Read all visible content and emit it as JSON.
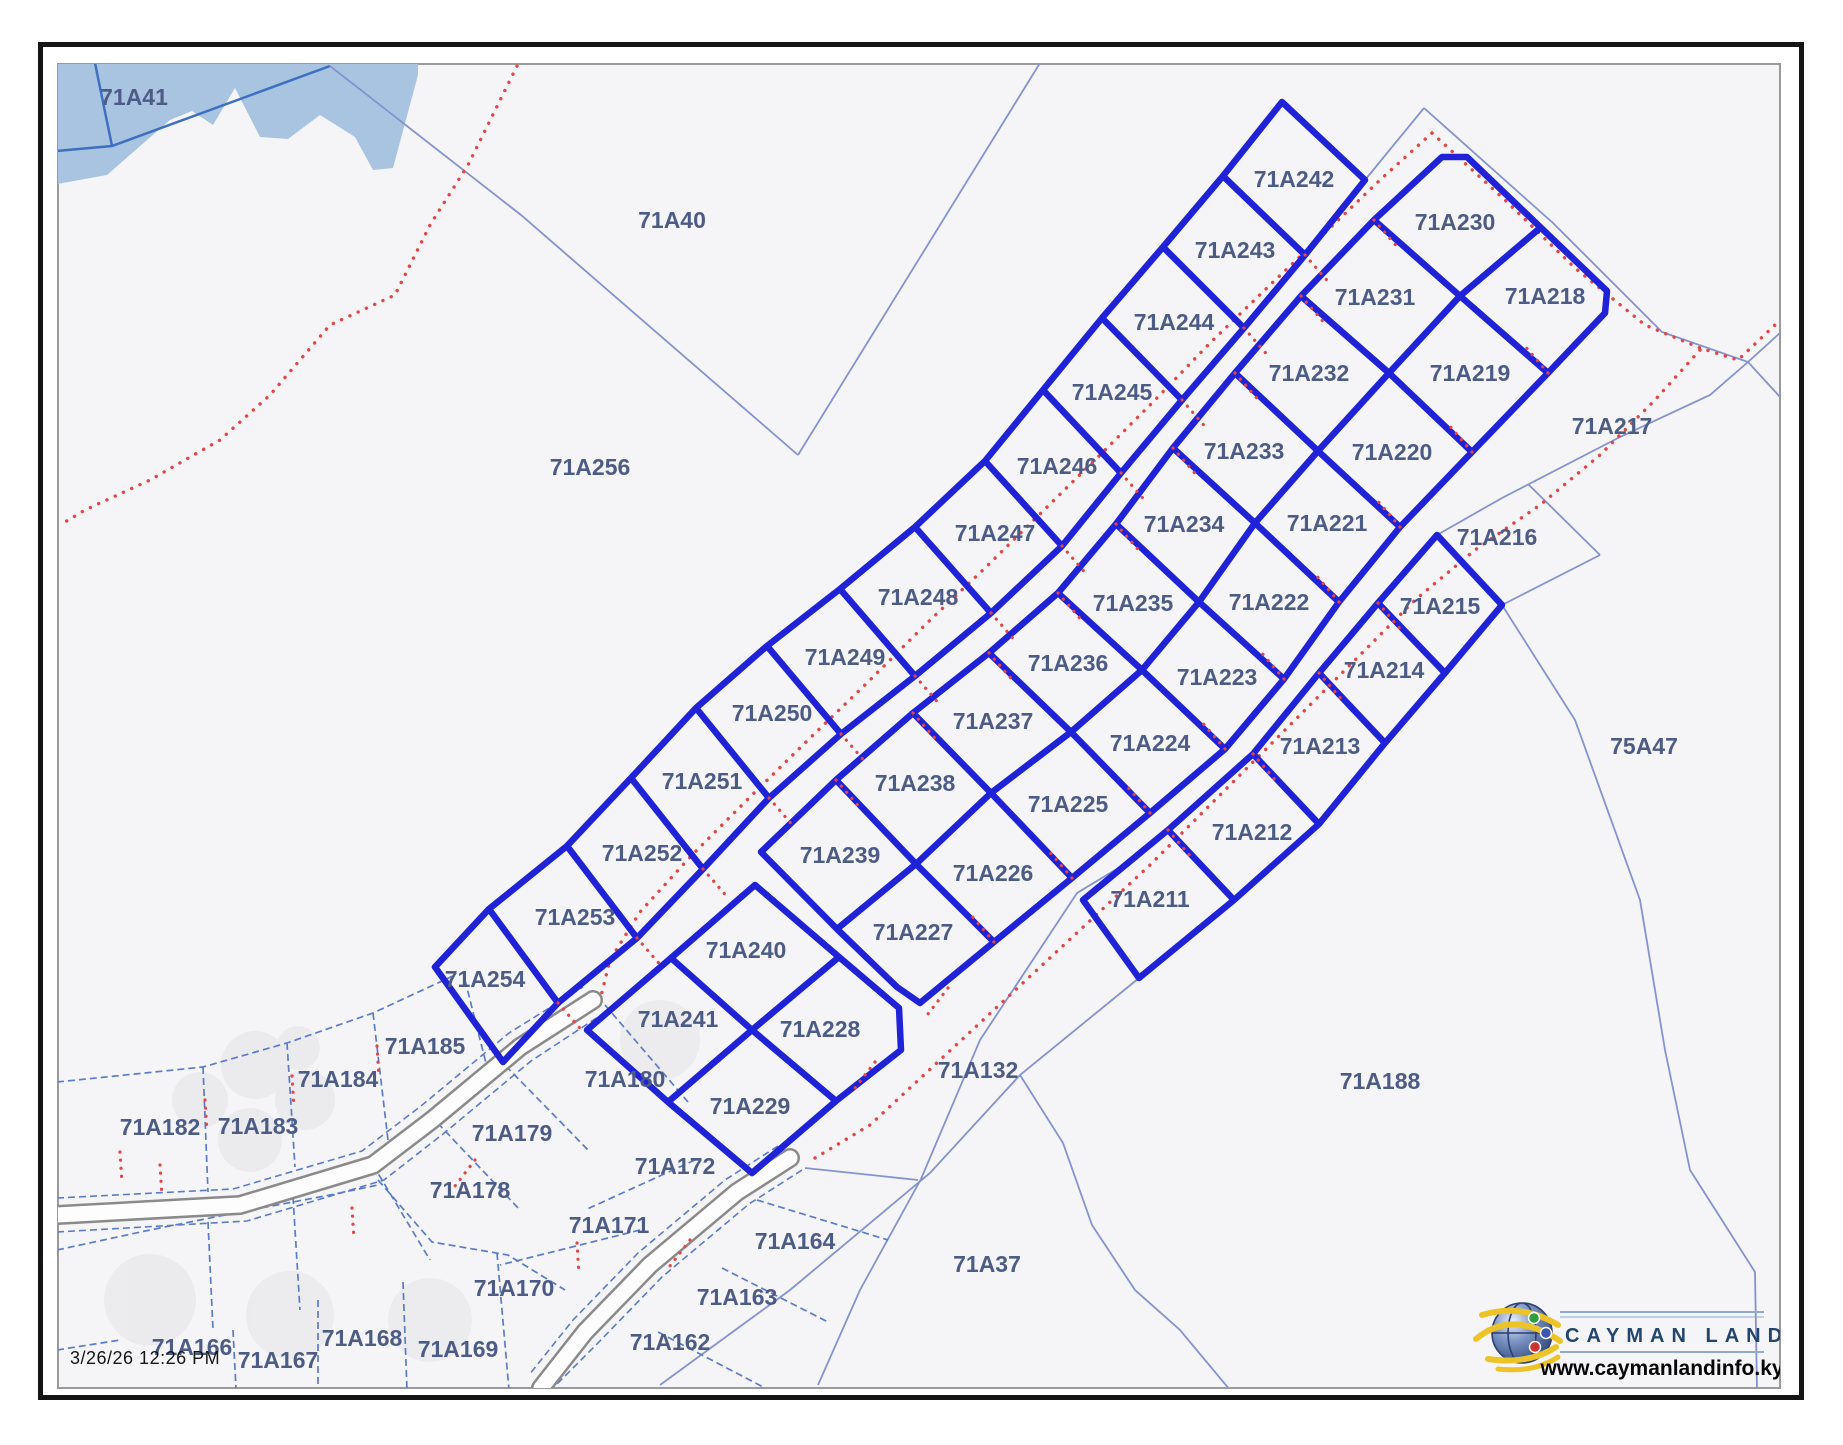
{
  "map": {
    "timestamp": "3/26/26 12:26 PM",
    "logo": {
      "brand": "CAYMAN LAND INFO",
      "url": "www.caymanlandinfo.ky"
    },
    "colors": {
      "highlight_boundary": "#1f22d6",
      "thin_boundary": "#8493cf",
      "village_boundary": "#5b7cc9",
      "road_casing": "#8a8a8a",
      "survey_marks": "#e34646",
      "water_fill": "#a9c4e1",
      "water_line": "#3f6fc1",
      "label_text": "#4d5c86"
    },
    "parcel_labels": [
      {
        "id": "71A41",
        "x": 134,
        "y": 97
      },
      {
        "id": "71A40",
        "x": 672,
        "y": 220
      },
      {
        "id": "71A256",
        "x": 590,
        "y": 467
      },
      {
        "id": "75A47",
        "x": 1644,
        "y": 746
      },
      {
        "id": "71A132",
        "x": 978,
        "y": 1070
      },
      {
        "id": "71A188",
        "x": 1380,
        "y": 1081
      },
      {
        "id": "71A37",
        "x": 987,
        "y": 1264
      },
      {
        "id": "71A242",
        "x": 1294,
        "y": 179
      },
      {
        "id": "71A243",
        "x": 1235,
        "y": 250
      },
      {
        "id": "71A244",
        "x": 1174,
        "y": 322
      },
      {
        "id": "71A245",
        "x": 1112,
        "y": 392
      },
      {
        "id": "71A246",
        "x": 1057,
        "y": 466
      },
      {
        "id": "71A247",
        "x": 995,
        "y": 533
      },
      {
        "id": "71A248",
        "x": 918,
        "y": 597
      },
      {
        "id": "71A249",
        "x": 845,
        "y": 657
      },
      {
        "id": "71A250",
        "x": 772,
        "y": 713
      },
      {
        "id": "71A251",
        "x": 702,
        "y": 781
      },
      {
        "id": "71A252",
        "x": 642,
        "y": 853
      },
      {
        "id": "71A253",
        "x": 575,
        "y": 917
      },
      {
        "id": "71A254",
        "x": 485,
        "y": 979
      },
      {
        "id": "71A230",
        "x": 1455,
        "y": 222
      },
      {
        "id": "71A231",
        "x": 1375,
        "y": 297
      },
      {
        "id": "71A232",
        "x": 1309,
        "y": 373
      },
      {
        "id": "71A233",
        "x": 1244,
        "y": 451
      },
      {
        "id": "71A234",
        "x": 1184,
        "y": 524
      },
      {
        "id": "71A235",
        "x": 1133,
        "y": 603
      },
      {
        "id": "71A236",
        "x": 1068,
        "y": 663
      },
      {
        "id": "71A237",
        "x": 993,
        "y": 721
      },
      {
        "id": "71A238",
        "x": 915,
        "y": 783
      },
      {
        "id": "71A239",
        "x": 840,
        "y": 855
      },
      {
        "id": "71A218",
        "x": 1545,
        "y": 296
      },
      {
        "id": "71A219",
        "x": 1470,
        "y": 373
      },
      {
        "id": "71A220",
        "x": 1392,
        "y": 452
      },
      {
        "id": "71A221",
        "x": 1327,
        "y": 523
      },
      {
        "id": "71A222",
        "x": 1269,
        "y": 602
      },
      {
        "id": "71A223",
        "x": 1217,
        "y": 677
      },
      {
        "id": "71A224",
        "x": 1150,
        "y": 743
      },
      {
        "id": "71A225",
        "x": 1068,
        "y": 804
      },
      {
        "id": "71A226",
        "x": 993,
        "y": 873
      },
      {
        "id": "71A227",
        "x": 913,
        "y": 932
      },
      {
        "id": "71A217",
        "x": 1612,
        "y": 426
      },
      {
        "id": "71A216",
        "x": 1497,
        "y": 537
      },
      {
        "id": "71A215",
        "x": 1440,
        "y": 606
      },
      {
        "id": "71A214",
        "x": 1384,
        "y": 670
      },
      {
        "id": "71A213",
        "x": 1320,
        "y": 746
      },
      {
        "id": "71A212",
        "x": 1252,
        "y": 832
      },
      {
        "id": "71A211",
        "x": 1150,
        "y": 899
      },
      {
        "id": "71A240",
        "x": 746,
        "y": 950
      },
      {
        "id": "71A241",
        "x": 678,
        "y": 1019
      },
      {
        "id": "71A228",
        "x": 820,
        "y": 1029
      },
      {
        "id": "71A229",
        "x": 750,
        "y": 1106
      },
      {
        "id": "71A185",
        "x": 425,
        "y": 1046
      },
      {
        "id": "71A184",
        "x": 338,
        "y": 1079
      },
      {
        "id": "71A183",
        "x": 258,
        "y": 1126
      },
      {
        "id": "71A182",
        "x": 160,
        "y": 1127
      },
      {
        "id": "71A180",
        "x": 625,
        "y": 1079
      },
      {
        "id": "71A179",
        "x": 512,
        "y": 1133
      },
      {
        "id": "71A178",
        "x": 470,
        "y": 1190
      },
      {
        "id": "71A172",
        "x": 675,
        "y": 1166
      },
      {
        "id": "71A171",
        "x": 609,
        "y": 1225
      },
      {
        "id": "71A170",
        "x": 514,
        "y": 1288
      },
      {
        "id": "71A164",
        "x": 795,
        "y": 1241
      },
      {
        "id": "71A163",
        "x": 737,
        "y": 1297
      },
      {
        "id": "71A162",
        "x": 670,
        "y": 1342
      },
      {
        "id": "71A166",
        "x": 192,
        "y": 1347
      },
      {
        "id": "71A167",
        "x": 278,
        "y": 1360
      },
      {
        "id": "71A168",
        "x": 362,
        "y": 1338
      },
      {
        "id": "71A169",
        "x": 458,
        "y": 1349
      }
    ]
  }
}
